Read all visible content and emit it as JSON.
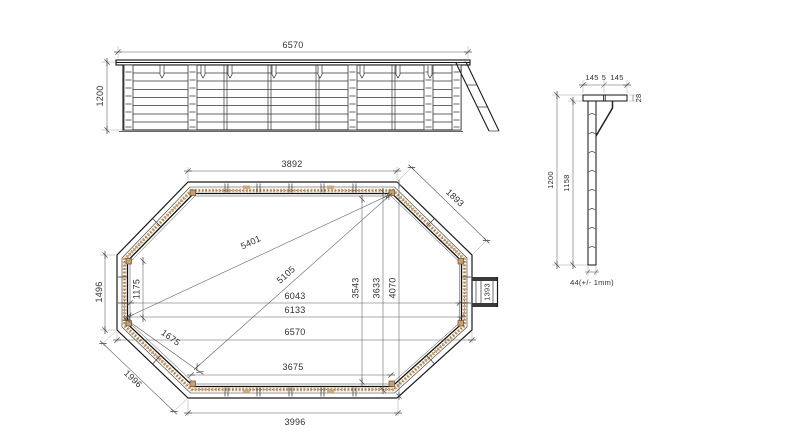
{
  "drawing_type": "octagonal-wooden-pool-technical-drawing",
  "elevation": {
    "length": "6570",
    "height": "1200"
  },
  "plan": {
    "top_width": "3892",
    "top_right_diagonal": "1893",
    "left_outer_height": "1496",
    "left_inner_height": "1175",
    "diagonal_a": "5401",
    "diagonal_b": "5105",
    "inner_length_a": "6043",
    "inner_length_b": "6133",
    "outer_length": "6570",
    "inner_height_a": "3543",
    "inner_height_b": "3633",
    "outer_height": "4070",
    "ladder_width": "1393",
    "bottom_inner_width": "3675",
    "bottom_outer_width": "3996",
    "bottom_left_diagonal": "1996",
    "bottom_left_inner": "1675"
  },
  "detail": {
    "cap_left": "145",
    "cap_gap": "5",
    "cap_right": "145",
    "cap_thickness": "28",
    "height_outer": "1200",
    "height_inner": "1158",
    "plank_width": "44(+/- 1mm)"
  },
  "colors": {
    "line": "#1a1a1a",
    "wood": "#c9a06d",
    "wood_dark": "#8a6a48"
  }
}
